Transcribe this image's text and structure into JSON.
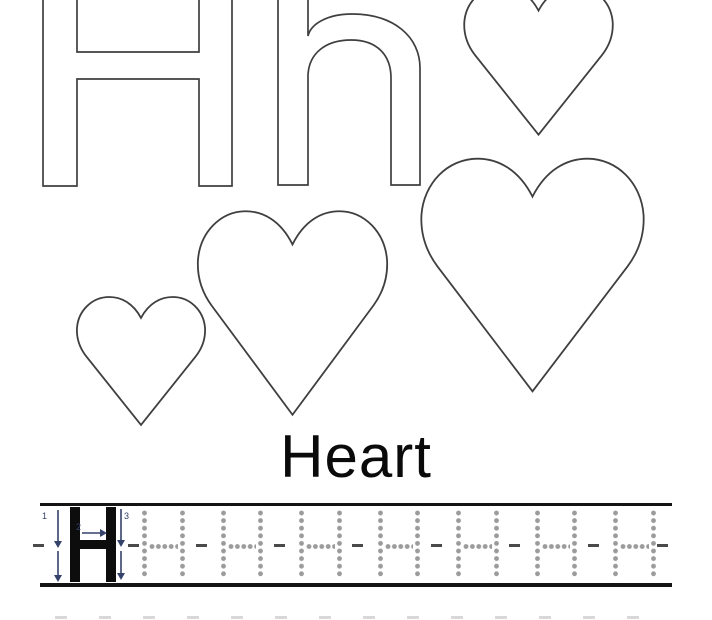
{
  "colors": {
    "bg": "#ffffff",
    "outline": "#3f3f3f",
    "text": "#0a0a0a",
    "line": "#141414",
    "letter": "#0d0d0d",
    "dot": "#9b9b9b",
    "dash": "#4a4a4a",
    "arrow": "#35426a",
    "faint": "#d8d8d8"
  },
  "letters": {
    "uppercase": "H",
    "lowercase": "h"
  },
  "word_label": "Heart",
  "hearts": [
    {
      "name": "heart-top-right",
      "x": 462,
      "y": -16,
      "w": 153,
      "h": 153
    },
    {
      "name": "heart-large",
      "x": 418,
      "y": 155,
      "w": 229,
      "h": 240
    },
    {
      "name": "heart-medium",
      "x": 195,
      "y": 208,
      "w": 195,
      "h": 210
    },
    {
      "name": "heart-small",
      "x": 75,
      "y": 295,
      "w": 132,
      "h": 132
    }
  ],
  "trace_row": {
    "solid_letter": "H",
    "stroke_numbers": [
      "1",
      "2",
      "3"
    ],
    "dotted_letters": {
      "count": 7,
      "start_x": 102,
      "pitch": 78.5,
      "col_gap": 37.5,
      "col_top": 4,
      "col_height": 68,
      "bar_y": 37.5
    },
    "mid_dashes": [
      -7,
      88,
      156,
      234,
      312,
      391,
      469,
      548,
      617
    ]
  },
  "next_row_hint": {
    "count": 14,
    "start_x": 55,
    "pitch": 44
  }
}
